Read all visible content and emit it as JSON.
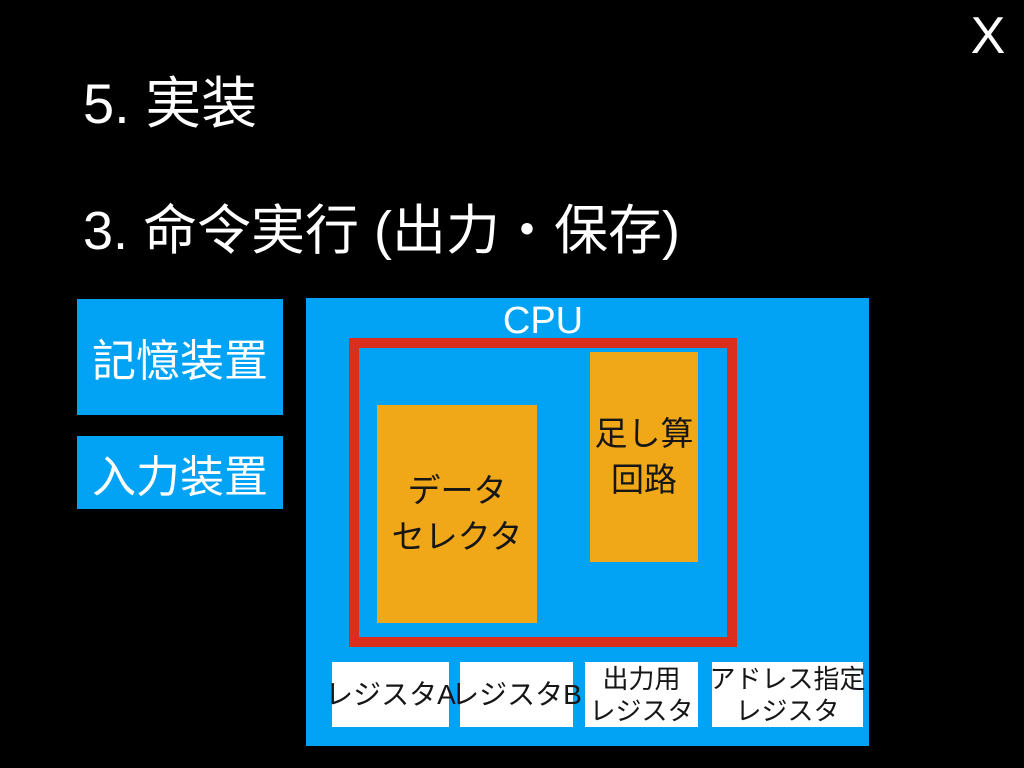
{
  "slide": {
    "close_label": "X",
    "title": "5. 実装",
    "subtitle": "3. 命令実行 (出力・保存)"
  },
  "colors": {
    "background": "#000000",
    "panel_blue": "#02A3F4",
    "accent_orange": "#F0A818",
    "frame_red": "#DB2F1E",
    "box_white": "#FFFFFF",
    "text_light": "#FFFFFF",
    "text_dark": "#161616"
  },
  "diagram": {
    "memory_device_label": "記憶装置",
    "input_device_label": "入力装置",
    "cpu_label": "CPU",
    "data_selector_lines": [
      "データ",
      "セレクタ"
    ],
    "adder_circuit_lines": [
      "足し算",
      "回路"
    ],
    "registers": [
      {
        "lines": [
          "レジスタA"
        ]
      },
      {
        "lines": [
          "レジスタB"
        ]
      },
      {
        "lines": [
          "出力用",
          "レジスタ"
        ]
      },
      {
        "lines": [
          "アドレス指定",
          "レジスタ"
        ]
      }
    ]
  }
}
